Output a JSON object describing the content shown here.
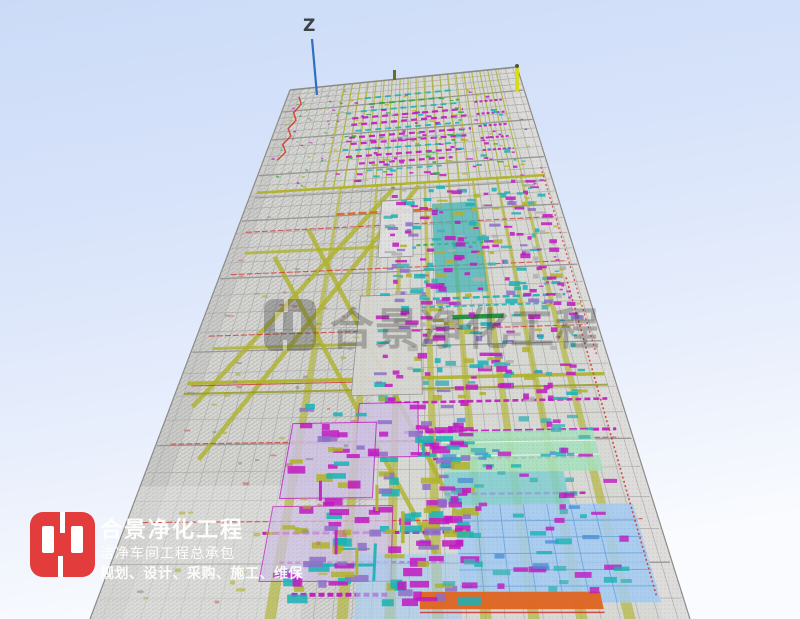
{
  "viewport": {
    "axis_label": "Z"
  },
  "watermark": {
    "text": "合景净化工程"
  },
  "logo": {
    "title": "合景净化工程",
    "subtitle": "洁净车间工程总承包",
    "services": "规划、设计、采购、施工、维保"
  },
  "palette": {
    "bg_top": "#cbdbf7",
    "bg_mid": "#d7e3fa",
    "bg_low": "#e9effc",
    "bg_bottom": "#f9fbfe",
    "structure": "#d8d8d5",
    "structure_line": "#a9a9a7",
    "structure_dark": "#8f8f8d",
    "mesh": "#9c9c9a",
    "olive": "#b0b32a",
    "olive_dark": "#9a9d22",
    "magenta": "#c217c2",
    "cyan": "#19b3b6",
    "teal_band": "#3db3b5",
    "green": "#2faa3e",
    "dark_green": "#1d8f3a",
    "red": "#cf3b34",
    "orange": "#e2631d",
    "blue_panel": "#a3cdf4",
    "blue_line": "#6aa3dc",
    "mint_panel": "#a6e3bd",
    "teal_panel": "#7dcfd2",
    "lavender": "#cfc2e6",
    "purple": "#8d6fc9",
    "logo_red": "#e23c3c",
    "axis_blue": "#2f6fbe",
    "text_dark": "#3c4148",
    "watermark_gray": "#353535",
    "white": "#ffffff"
  }
}
